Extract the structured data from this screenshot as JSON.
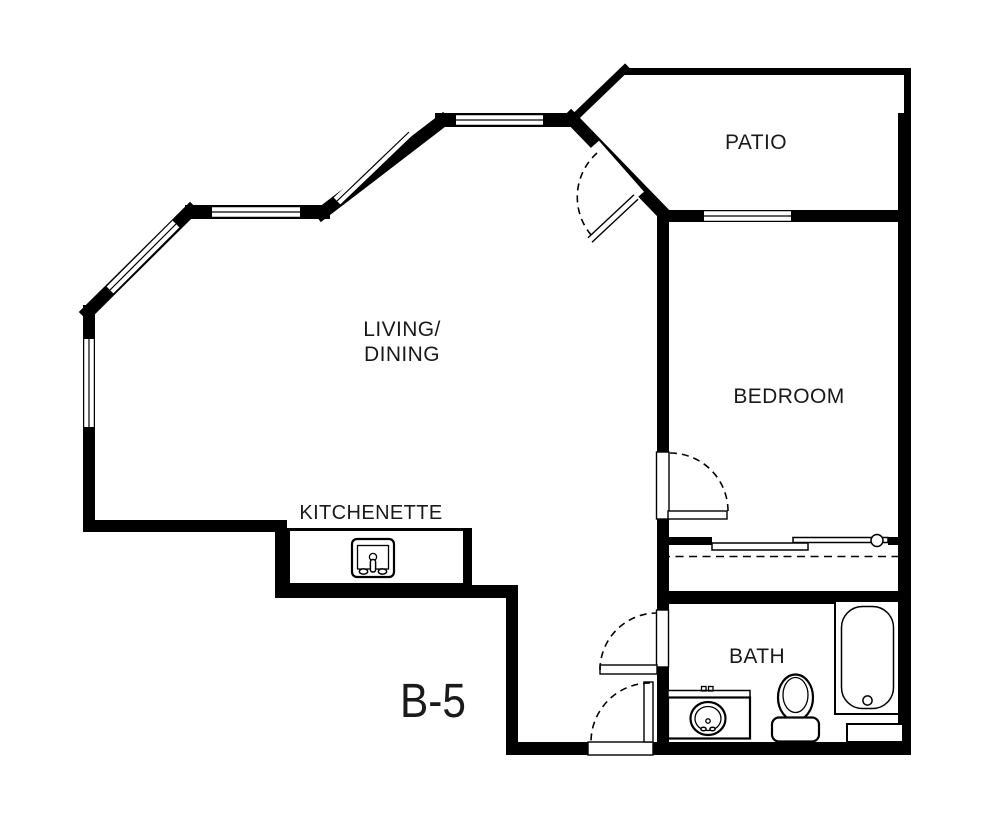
{
  "floor_plan": {
    "colors": {
      "wall": "#000000",
      "background": "#ffffff",
      "text": "#1a1a1a"
    },
    "unit_label": "B-5",
    "rooms": {
      "patio": {
        "label": "PATIO"
      },
      "living_dining": {
        "label_line1": "LIVING/",
        "label_line2": "DINING"
      },
      "bedroom": {
        "label": "BEDROOM"
      },
      "kitchenette": {
        "label": "KITCHENETTE"
      },
      "bath": {
        "label": "BATH"
      }
    },
    "fixtures": [
      "kitchen-sink-icon",
      "vanity-sink-icon",
      "toilet-icon",
      "bathtub-icon",
      "closet-sliding-doors",
      "swing-door-patio",
      "swing-door-bedroom",
      "swing-door-bath",
      "swing-door-entry"
    ]
  }
}
